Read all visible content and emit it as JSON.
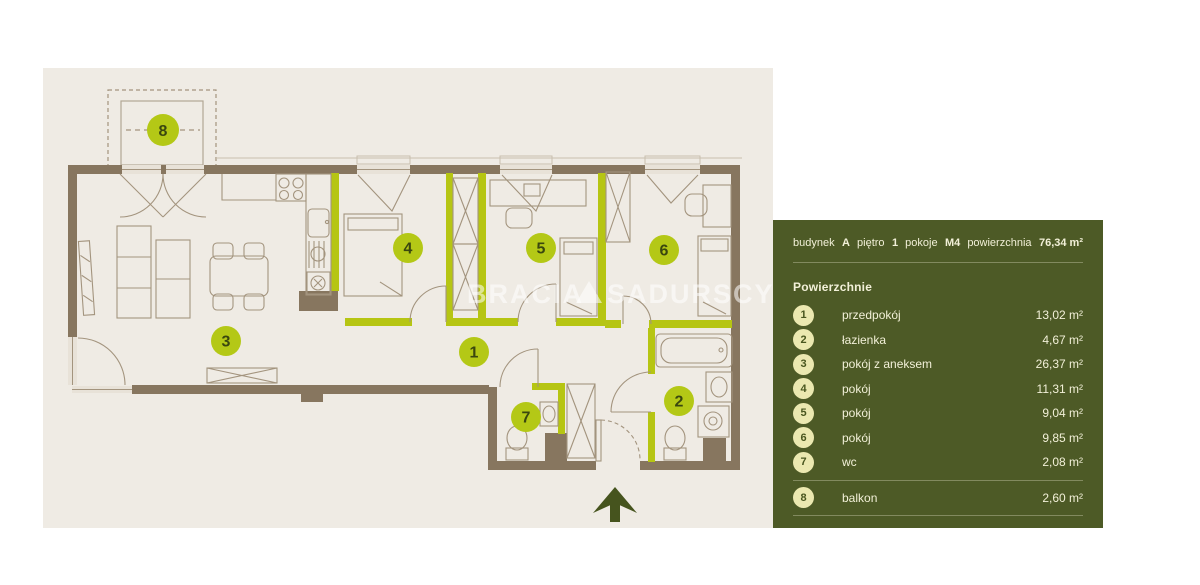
{
  "plan": {
    "room_labels": [
      {
        "id": "1",
        "x": 474,
        "y": 352
      },
      {
        "id": "2",
        "x": 679,
        "y": 401
      },
      {
        "id": "3",
        "x": 226,
        "y": 341
      },
      {
        "id": "4",
        "x": 408,
        "y": 248
      },
      {
        "id": "5",
        "x": 541,
        "y": 248
      },
      {
        "id": "6",
        "x": 664,
        "y": 250
      },
      {
        "id": "7",
        "x": 526,
        "y": 417
      },
      {
        "id": "8",
        "x": 163,
        "y": 130
      }
    ],
    "watermark": {
      "part1": "BRACIA",
      "part2": "SADURSCY"
    },
    "colors": {
      "plan_background": "#efebe4",
      "wall_brown": "#87765f",
      "accent_lime": "#b6c513",
      "panel_olive": "#4d5a26",
      "panel_circle": "#ebe8b0",
      "panel_text": "#f2f0d8",
      "north_arrow_green": "#46541e"
    }
  },
  "panel": {
    "header": [
      {
        "label": "budynek",
        "value": "A"
      },
      {
        "label": "piętro",
        "value": "1"
      },
      {
        "label": "pokoje",
        "value": "M4"
      },
      {
        "label": "powierzchnia",
        "value": "76,34 m²"
      }
    ],
    "section_title": "Powierzchnie",
    "rooms": [
      {
        "num": "1",
        "name": "przedpokój",
        "area": "13,02 m²"
      },
      {
        "num": "2",
        "name": "łazienka",
        "area": "4,67 m²"
      },
      {
        "num": "3",
        "name": "pokój z aneksem",
        "area": "26,37 m²"
      },
      {
        "num": "4",
        "name": "pokój",
        "area": "11,31 m²"
      },
      {
        "num": "5",
        "name": "pokój",
        "area": "9,04 m²"
      },
      {
        "num": "6",
        "name": "pokój",
        "area": "9,85 m²"
      },
      {
        "num": "7",
        "name": "wc",
        "area": "2,08 m²"
      },
      {
        "num": "8",
        "name": "balkon",
        "area": "2,60 m²"
      }
    ]
  }
}
